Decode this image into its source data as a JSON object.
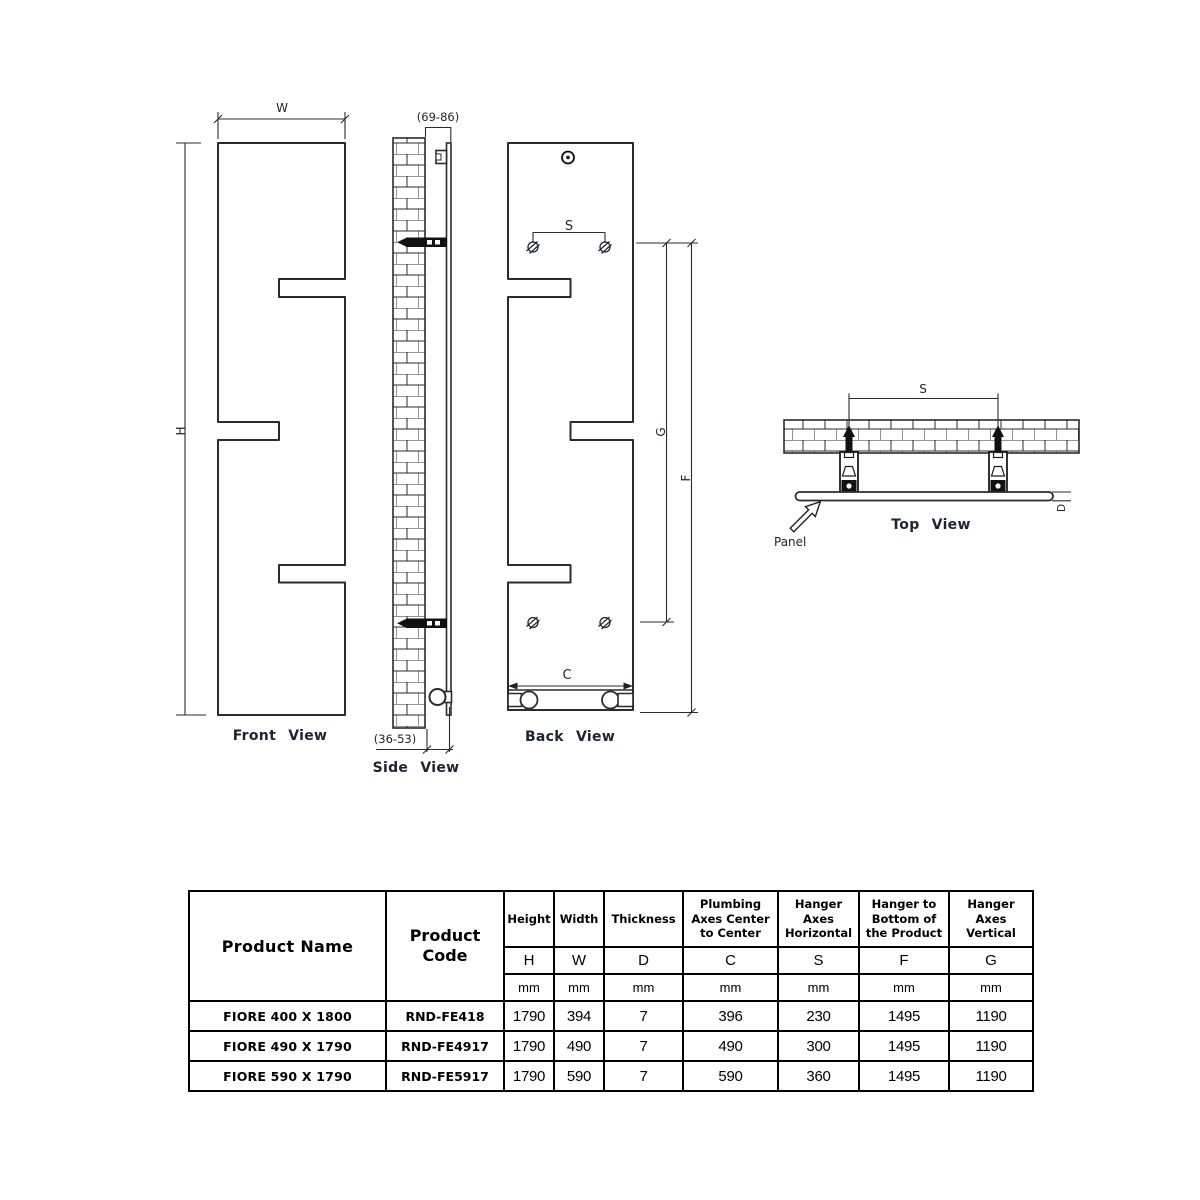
{
  "drawing": {
    "front_view": {
      "title": "Front View",
      "dim_width": "W",
      "dim_height": "H"
    },
    "side_view": {
      "title": "Side View",
      "dim_wall_clearance_front": "(69-86)",
      "dim_wall_clearance_back": "(36-53)"
    },
    "back_view": {
      "title": "Back View",
      "dim_hanger_axes_horizontal": "S",
      "dim_plumbing_axes": "C",
      "dim_hanger_axes_vertical": "G",
      "dim_hanger_to_bottom": "F"
    },
    "top_view": {
      "title": "Top View",
      "dim_hanger_axes_horizontal": "S",
      "dim_thickness": "D",
      "panel_label": "Panel"
    }
  },
  "table": {
    "product_name_header": "Product Name",
    "product_code_header": "Product\nCode",
    "columns": [
      {
        "group": "Height",
        "letter": "H",
        "unit": "mm"
      },
      {
        "group": "Width",
        "letter": "W",
        "unit": "mm"
      },
      {
        "group": "Thickness",
        "letter": "D",
        "unit": "mm"
      },
      {
        "group": "Plumbing Axes Center to Center",
        "letter": "C",
        "unit": "mm"
      },
      {
        "group": "Hanger Axes Horizontal",
        "letter": "S",
        "unit": "mm"
      },
      {
        "group": "Hanger to Bottom of the Product",
        "letter": "F",
        "unit": "mm"
      },
      {
        "group": "Hanger Axes Vertical",
        "letter": "G",
        "unit": "mm"
      }
    ],
    "rows": [
      {
        "name": "FIORE 400 X 1800",
        "code": "RND-FE418",
        "values": [
          "1790",
          "394",
          "7",
          "396",
          "230",
          "1495",
          "1190"
        ]
      },
      {
        "name": "FIORE 490 X 1790",
        "code": "RND-FE4917",
        "values": [
          "1790",
          "490",
          "7",
          "490",
          "300",
          "1495",
          "1190"
        ]
      },
      {
        "name": "FIORE 590 X 1790",
        "code": "RND-FE5917",
        "values": [
          "1790",
          "590",
          "7",
          "590",
          "360",
          "1495",
          "1190"
        ]
      }
    ]
  }
}
